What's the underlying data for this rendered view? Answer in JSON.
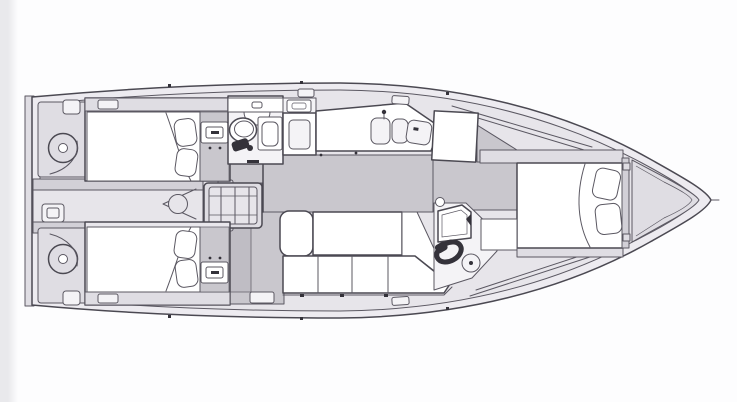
{
  "meta": {
    "label": "yacht-interior-floor-plan",
    "view": "top-down-deck-plan"
  },
  "colors": {
    "background": "#fdfdfe",
    "background_edge": "#e9e9ec",
    "outline": "#5b5862",
    "outline_bold": "#4b4952",
    "deck": "#edebf0",
    "interior": "#e7e5ea",
    "panel": "#dfdde3",
    "panel_dark": "#d2d0d7",
    "cabin": "#e9e7ec",
    "floor": "#c9c7cd",
    "floor_dark": "#bfbdc4",
    "furniture": "#ffffff",
    "furniture_dim": "#f4f3f6",
    "accent_dark": "#34323a"
  },
  "parts": {
    "stern": [
      "transom-platform",
      "port-helm-wheel",
      "starboard-helm-wheel",
      "cockpit-walkway",
      "transom-locker",
      "engine-hatch",
      "companionway-steps"
    ],
    "port_aft_cabin": [
      "double-berth",
      "pillows",
      "vanity"
    ],
    "starboard_aft_cabin": [
      "double-berth",
      "pillows",
      "vanity"
    ],
    "head": [
      "toilet",
      "washbasin",
      "shower"
    ],
    "galley": [
      "stove",
      "double-sink",
      "worktop"
    ],
    "saloon": [
      "settee-chaise",
      "table",
      "seat-cushions"
    ],
    "nav_station": [
      "chart-table",
      "seat",
      "stool"
    ],
    "forward_cabin": [
      "v-berth",
      "pillows",
      "wardrobe",
      "seat"
    ],
    "bow": [
      "anchor-locker"
    ]
  }
}
